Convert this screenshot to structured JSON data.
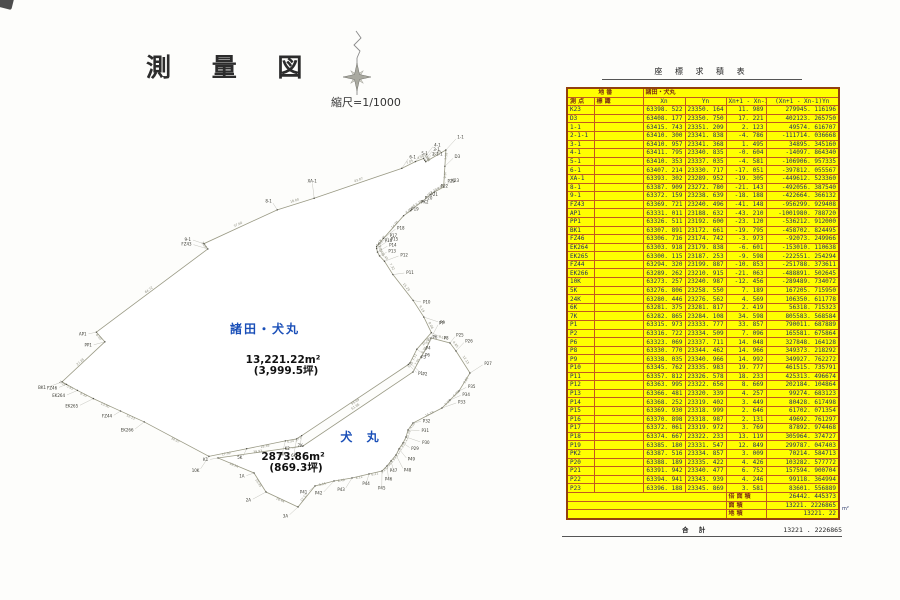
{
  "page": {
    "title": "測 量 図",
    "scale_label": "縮尺=1/1000"
  },
  "map": {
    "view": {
      "origin_x": 62,
      "origin_y": 150,
      "px_per_m": 2.15,
      "y_min": 23172.661,
      "x_max": 63415.743
    },
    "colors": {
      "parcel_main_fill": "#ffff00",
      "parcel_sub_fill": "#cfe8d6",
      "outline": "#9a9a85",
      "parcel_name": "#1a4fb8",
      "area_text": "#111111",
      "point_label": "#3a3a32",
      "leader": "#9a9a90",
      "edge_len": "#8a8a7a"
    },
    "parcels": [
      {
        "id": "morota-inumaru",
        "name": "諸田・犬丸",
        "area_label": "13,221.22m²",
        "tsubo_label": "(3,999.5坪)",
        "name_pos": [
          265,
          333
        ],
        "name_spacing": 2,
        "area_pos": [
          283,
          363
        ],
        "points_from": "survey_table"
      },
      {
        "id": "inumaru",
        "name": "犬 丸",
        "area_label": "2873.86m²",
        "tsubo_label": "(869.3坪)",
        "name_pos": [
          362,
          441
        ],
        "name_spacing": 5,
        "area_pos": [
          293,
          460
        ],
        "outline_px": [
          [
            218,
            458
          ],
          [
            303,
            446
          ],
          [
            413,
            372
          ],
          [
            421,
            357
          ],
          [
            426,
            349
          ],
          [
            431,
            338
          ],
          [
            450,
            343
          ],
          [
            456,
            351
          ],
          [
            470,
            373
          ],
          [
            459,
            391
          ],
          [
            450,
            400
          ],
          [
            442,
            408
          ],
          [
            413,
            423
          ],
          [
            408,
            430
          ],
          [
            406,
            437
          ],
          [
            403,
            443
          ],
          [
            399,
            449
          ],
          [
            396,
            455
          ],
          [
            391,
            461
          ],
          [
            387,
            466
          ],
          [
            382,
            471
          ],
          [
            369,
            474
          ],
          [
            352,
            478
          ],
          [
            334,
            481
          ],
          [
            315,
            486
          ],
          [
            298,
            507
          ],
          [
            266,
            492
          ],
          [
            254,
            473
          ]
        ],
        "point_names": [
          "K1",
          "K2",
          "P3",
          "P4",
          "P6",
          "P7",
          "P25",
          "P26",
          "P27",
          "P35",
          "P34",
          "P33",
          "P32",
          "P31",
          "P30",
          "P29",
          "P49",
          "P48",
          "P47",
          "P46",
          "P45",
          "P44",
          "P43",
          "P42",
          "P41",
          "3A",
          "2A",
          "1A"
        ]
      }
    ]
  },
  "table": {
    "title": "座 標 求 積 表",
    "parcel_header_label": "地 番",
    "parcel_header_value": "諸田・犬丸",
    "columns": [
      "測 点",
      "標 識",
      "Xn",
      "Yn",
      "Xn+1 - Xn-1",
      "(Xn+1 - Xn-1)Yn"
    ],
    "rows": [
      {
        "name": "K23",
        "x": "63398. 522",
        "y": "23350. 164",
        "d": "11. 989",
        "p": "279945. 116196"
      },
      {
        "name": "D3",
        "x": "63408. 177",
        "y": "23350. 750",
        "d": "17. 221",
        "p": "402123. 265750"
      },
      {
        "name": "1-1",
        "x": "63415. 743",
        "y": "23351. 209",
        "d": "2. 123",
        "p": "49574. 616707"
      },
      {
        "name": "2-1-1",
        "x": "63410. 300",
        "y": "23341. 838",
        "d": "-4. 786",
        "p": "-111714. 036668"
      },
      {
        "name": "3-1",
        "x": "63410. 957",
        "y": "23341. 368",
        "d": "1. 495",
        "p": "34895. 345160"
      },
      {
        "name": "4-1",
        "x": "63411. 795",
        "y": "23340. 835",
        "d": "-0. 604",
        "p": "-14097. 864340"
      },
      {
        "name": "5-1",
        "x": "63410. 353",
        "y": "23337. 035",
        "d": "-4. 581",
        "p": "-106906. 957335"
      },
      {
        "name": "6-1",
        "x": "63407. 214",
        "y": "23330. 717",
        "d": "-17. 051",
        "p": "-397812. 055567"
      },
      {
        "name": "XA-1",
        "x": "63393. 302",
        "y": "23289. 952",
        "d": "-19. 305",
        "p": "-449612. 523360"
      },
      {
        "name": "8-1",
        "x": "63387. 909",
        "y": "23272. 780",
        "d": "-21. 143",
        "p": "-492056. 387540"
      },
      {
        "name": "9-1",
        "x": "63372. 159",
        "y": "23238. 639",
        "d": "-18. 188",
        "p": "-422664. 366132"
      },
      {
        "name": "FZ43",
        "x": "63369. 721",
        "y": "23240. 496",
        "d": "-41. 148",
        "p": "-956299. 929408"
      },
      {
        "name": "AP1",
        "x": "63331. 011",
        "y": "23188. 632",
        "d": "-43. 210",
        "p": "-1001980. 788720"
      },
      {
        "name": "PP1",
        "x": "63326. 511",
        "y": "23192. 600",
        "d": "-23. 120",
        "p": "-536212. 912000"
      },
      {
        "name": "BK1",
        "x": "63307. 891",
        "y": "23172. 661",
        "d": "-19. 795",
        "p": "-458702. 824495"
      },
      {
        "name": "FZ46",
        "x": "63306. 716",
        "y": "23174. 742",
        "d": "-3. 973",
        "p": "-92073. 249966"
      },
      {
        "name": "EK264",
        "x": "63303. 918",
        "y": "23179. 838",
        "d": "-6. 601",
        "p": "-153010. 110638"
      },
      {
        "name": "EK265",
        "x": "63300. 115",
        "y": "23187. 253",
        "d": "-9. 598",
        "p": "-222551. 254294"
      },
      {
        "name": "FZ44",
        "x": "63294. 320",
        "y": "23199. 887",
        "d": "-10. 853",
        "p": "-251788. 373611"
      },
      {
        "name": "EK266",
        "x": "63289. 262",
        "y": "23210. 915",
        "d": "-21. 063",
        "p": "-488891. 502645"
      },
      {
        "name": "10K",
        "x": "63273. 257",
        "y": "23240. 987",
        "d": "-12. 456",
        "p": "-289489. 734072"
      },
      {
        "name": "5K",
        "x": "63276. 806",
        "y": "23258. 550",
        "d": "7. 189",
        "p": "167205. 715950"
      },
      {
        "name": "24K",
        "x": "63280. 446",
        "y": "23276. 562",
        "d": "4. 569",
        "p": "106350. 611778"
      },
      {
        "name": "6K",
        "x": "63281. 375",
        "y": "23281. 817",
        "d": "2. 419",
        "p": "56318. 715323"
      },
      {
        "name": "7K",
        "x": "63282. 865",
        "y": "23284. 108",
        "d": "34. 598",
        "p": "805583. 568584"
      },
      {
        "name": "P1",
        "x": "63315. 973",
        "y": "23333. 777",
        "d": "33. 857",
        "p": "790011. 687889"
      },
      {
        "name": "P2",
        "x": "63316. 722",
        "y": "23334. 509",
        "d": "7. 096",
        "p": "165581. 675864"
      },
      {
        "name": "P6",
        "x": "63323. 069",
        "y": "23337. 711",
        "d": "14. 048",
        "p": "327848. 164128"
      },
      {
        "name": "P8",
        "x": "63330. 770",
        "y": "23344. 462",
        "d": "14. 966",
        "p": "349373. 218292"
      },
      {
        "name": "P9",
        "x": "63338. 035",
        "y": "23340. 966",
        "d": "14. 992",
        "p": "349927. 762272"
      },
      {
        "name": "P10",
        "x": "63345. 762",
        "y": "23335. 983",
        "d": "19. 777",
        "p": "461515. 735791"
      },
      {
        "name": "P11",
        "x": "63357. 812",
        "y": "23326. 578",
        "d": "18. 233",
        "p": "425313. 496674"
      },
      {
        "name": "P12",
        "x": "63363. 995",
        "y": "23322. 656",
        "d": "8. 669",
        "p": "202184. 104864"
      },
      {
        "name": "P13",
        "x": "63366. 481",
        "y": "23320. 339",
        "d": "4. 257",
        "p": "99274. 683123"
      },
      {
        "name": "P14",
        "x": "63368. 252",
        "y": "23319. 402",
        "d": "3. 449",
        "p": "80428. 617498"
      },
      {
        "name": "P15",
        "x": "63369. 930",
        "y": "23318. 999",
        "d": "2. 646",
        "p": "61702. 071354"
      },
      {
        "name": "P16",
        "x": "63370. 898",
        "y": "23318. 987",
        "d": "2. 131",
        "p": "49692. 761297"
      },
      {
        "name": "P17",
        "x": "63372. 061",
        "y": "23319. 972",
        "d": "3. 769",
        "p": "87892. 974468"
      },
      {
        "name": "P18",
        "x": "63374. 667",
        "y": "23322. 233",
        "d": "13. 119",
        "p": "305964. 374727"
      },
      {
        "name": "P19",
        "x": "63385. 180",
        "y": "23331. 547",
        "d": "12. 849",
        "p": "299787. 047403"
      },
      {
        "name": "PK2",
        "x": "63387. 516",
        "y": "23334. 857",
        "d": "3. 009",
        "p": "70214. 584713"
      },
      {
        "name": "P20",
        "x": "63388. 189",
        "y": "23335. 422",
        "d": "4. 426",
        "p": "103282. 577772"
      },
      {
        "name": "P21",
        "x": "63391. 942",
        "y": "23340. 477",
        "d": "6. 752",
        "p": "157594. 900704"
      },
      {
        "name": "P22",
        "x": "63394. 941",
        "y": "23343. 939",
        "d": "4. 246",
        "p": "99118. 364994"
      },
      {
        "name": "P23",
        "x": "63396. 188",
        "y": "23345. 869",
        "d": "3. 581",
        "p": "83601. 556889"
      }
    ],
    "footer": [
      {
        "label": "倍 面 積",
        "value": "26442. 445373"
      },
      {
        "label": "面 積",
        "value": "13221. 2226865"
      },
      {
        "label": "地 積",
        "value": "13221. 22"
      }
    ],
    "footer_unit": "m²",
    "total": {
      "label": "合 計",
      "value": "13221 . 2226865"
    }
  }
}
